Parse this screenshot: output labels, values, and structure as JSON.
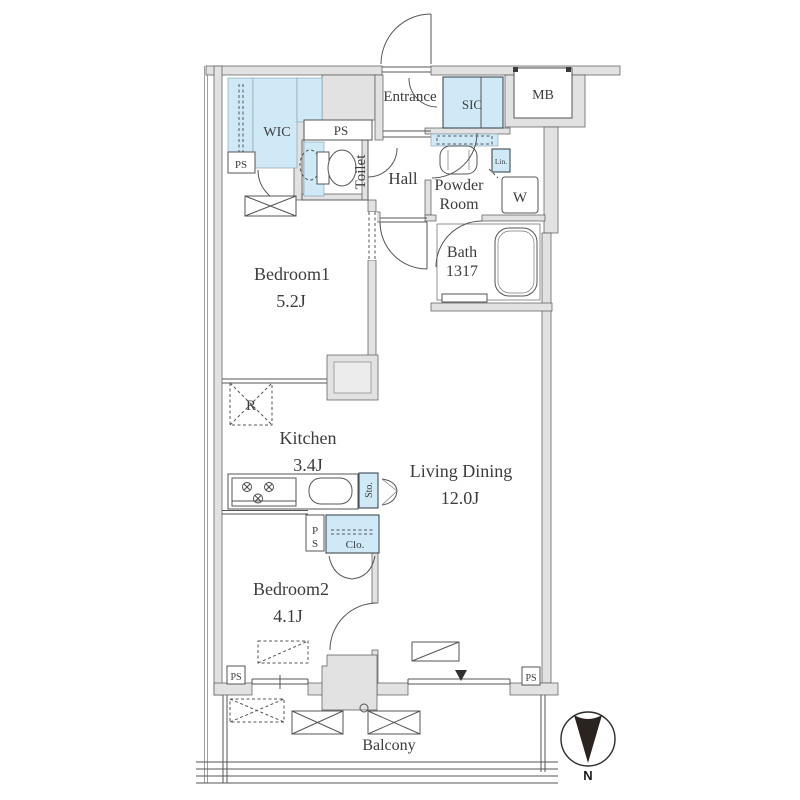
{
  "title": "apartment-floor-plan",
  "labels": {
    "wic": "WIC",
    "ps": "PS",
    "entrance": "Entrance",
    "sic": "SIC",
    "mb": "MB",
    "toilet": "Toilet",
    "hall": "Hall",
    "powder_line1": "Powder",
    "powder_line2": "Room",
    "lin": "Lin.",
    "washer": "W",
    "bath": "Bath",
    "bath_size": "1317",
    "bedroom1": "Bedroom1",
    "bedroom1_size": "5.2J",
    "kitchen": "Kitchen",
    "kitchen_size": "3.4J",
    "living": "Living Dining",
    "living_size": "12.0J",
    "bedroom2": "Bedroom2",
    "bedroom2_size": "4.1J",
    "balcony": "Balcony",
    "closet": "Clo.",
    "storage": "Sto.",
    "refrigerator": "R",
    "north": "N",
    "ps_stack": [
      "P",
      "S"
    ]
  },
  "colors": {
    "wall_fill": "#e2e2e2",
    "line": "#555555",
    "fixture_blue": "#cfe9f7",
    "text": "#3c3c3c"
  }
}
